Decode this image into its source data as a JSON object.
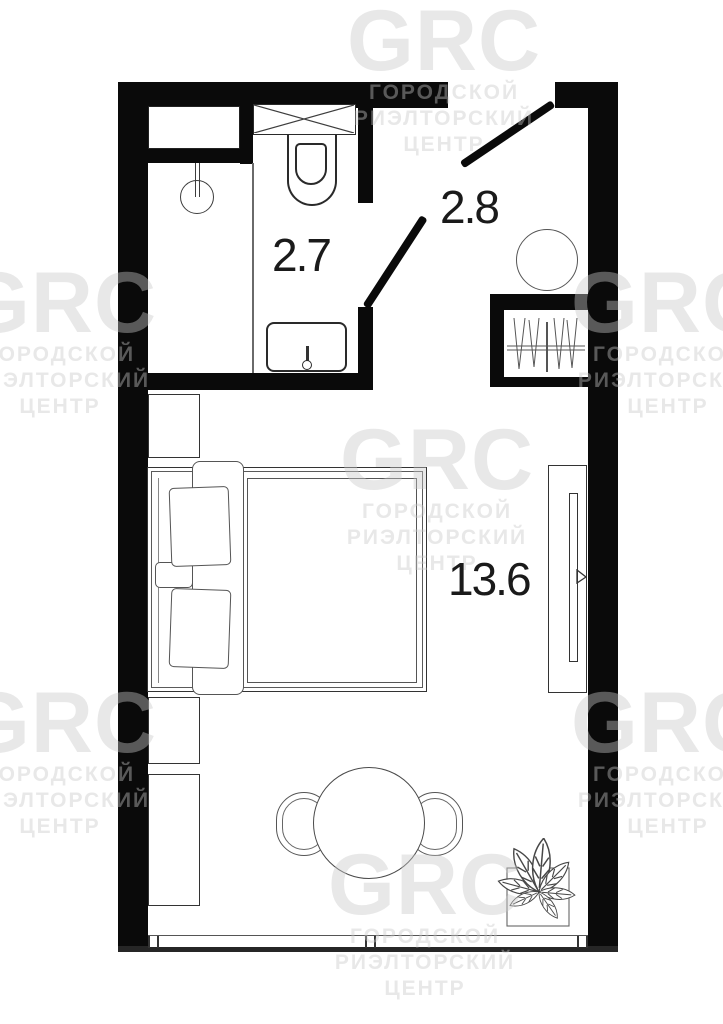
{
  "document": {
    "type": "apartment-floor-plan"
  },
  "colors": {
    "wall": "#0a0a0a",
    "fixture_line": "#3d3d3d",
    "furniture_line": "#555555",
    "background": "#ffffff",
    "watermark_text": "rgba(200,200,200,0.42)",
    "label_text": "#1a1a1a"
  },
  "rooms": {
    "bathroom": {
      "label": "2.7"
    },
    "hallway": {
      "label": "2.8"
    },
    "living_room": {
      "label": "13.6"
    }
  },
  "watermark": {
    "logo": "GRC",
    "line1": "ГОРОДСКОЙ",
    "line2": "РИЭЛТОРСКИЙ",
    "line3": "ЦЕНТР"
  },
  "symbols": {
    "bathroom": [
      "ventilation-niche",
      "shower-drain",
      "cistern-shelf-crosshatch",
      "toilet",
      "washbasin-with-faucet",
      "door-leaf"
    ],
    "hallway": [
      "entrance-door-leaf",
      "round-stool",
      "wardrobe-with-hangers"
    ],
    "living_room": [
      "nightstand",
      "double-bed-with-pillows",
      "bed-runner",
      "nightstand",
      "desk",
      "tv-console",
      "tv",
      "round-table",
      "chair",
      "chair",
      "potted-plant",
      "window"
    ]
  }
}
